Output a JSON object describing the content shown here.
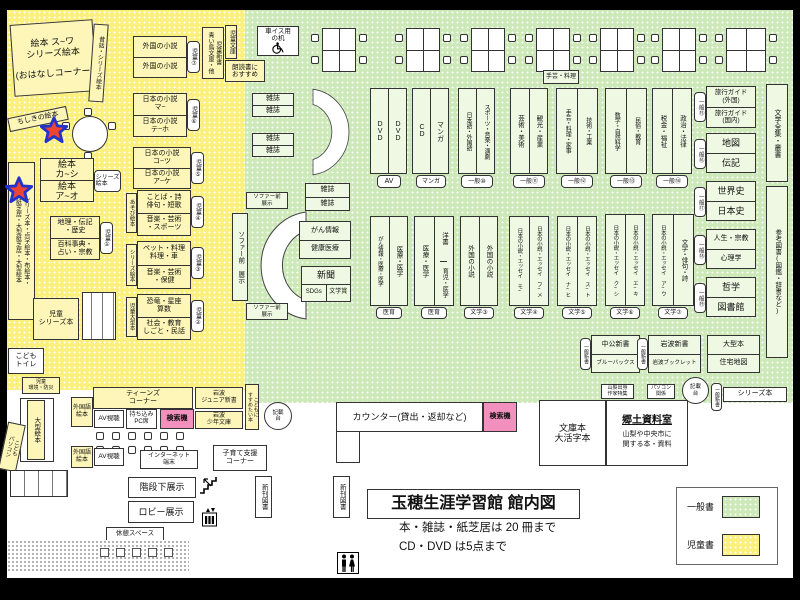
{
  "title": {
    "main": "玉穂生涯学習館 館内図",
    "note1": "本・雑誌・紙芝居は 20 冊まで",
    "note2": "CD・DVD は5点まで"
  },
  "legend": {
    "general": "一般書",
    "children": "児童書"
  },
  "children_zone": {
    "ehon_corner": "絵本 ス~ワ\nシリーズ絵本\n\n(おはなしコーナー)",
    "mukashibanashi": "昔話・シリーズ絵本",
    "chishiki_ehon": "ちしきの絵本",
    "special_ehon": "シリーズ本・点字絵本・布絵本・\n紙芝居・大型紙芝居・大型絵本",
    "ehon_ka_shi": "絵本\nカ~シ",
    "ehon_a_o": "絵本\nア~オ",
    "series_ehon": "シリーズ\n絵本",
    "chiri": "地理・伝記\n・歴史",
    "hyakka": "百科事典・\n占い・宗教",
    "badge_jido1": "児童①",
    "gaikoku_1": "外国の小説",
    "gaikoku_2": "外国の小説",
    "badge_jido7": "児童⑦",
    "nihon_ma": "日本の小説\nマ~",
    "nihon_teho": "日本の小説\nテ~ホ",
    "badge_jido6": "児童⑥",
    "nihon_kotsu": "日本の小説\nコ~ツ",
    "nihon_ake": "日本の小説\nア~ケ",
    "badge_jido5": "児童⑤",
    "kotoba": "ことば・詩\n俳句・短歌",
    "ongaku_sports": "音楽・芸術\n・スポーツ",
    "asobi_ehon": "あそび絵本",
    "badge_jido4": "児童④",
    "pet": "ペット・料理\n料理・車",
    "ongaku_hoken": "音楽・芸術\n・保健",
    "series_ehon_side": "シリーズ絵本",
    "badge_jido3": "児童③",
    "kyoryu": "恐竜・星座\n算数",
    "shakai": "社会・教育\nしごと・民話",
    "jido_ogata": "児童大型本",
    "badge_jido2": "児童②",
    "jido_shinsho": "児童新書\n青い鳥文庫・他",
    "jido_bunko": "児童文庫",
    "rodoku": "朗読書に\nおすすめ",
    "jido_series": "児童\nシリーズ本",
    "kodomo_toilet": "こども\nトイレ",
    "jido_kankyo": "児童\n環境・防災",
    "ogata_ehon": "大型絵本",
    "kodomo_pc": "こども\nパソコン"
  },
  "teens_zone": {
    "teens_corner": "ティーンズ\nコーナー",
    "gaikokugo_ehon1": "外国語\n絵本",
    "gaikokugo_ehon2": "外国語\n絵本",
    "av1": "AV視聴",
    "av2": "AV視聴",
    "pc_seat": "持ち込み\nPC席",
    "search1": "検索機",
    "iwanami_junior": "岩波\nジュニア新書",
    "iwanami_shonen": "岩波\n少年文庫",
    "kodomoni": "こどもに\nすすめたい本",
    "internet": "インターネット\n端末",
    "kosodate": "子育て支援\nコーナー",
    "kaidan": "階段下展示",
    "lobby": "ロビー展示",
    "kyukei": "休憩スペース",
    "shinkan1": "新刊図書",
    "shinkan2": "新刊図書"
  },
  "general_zone": {
    "wheelchair_desk": "車イス用\nの机",
    "zasshi": "雑誌",
    "shugei_ryori": "手芸・料理",
    "sofa_exhibit_h1": "ソファー前\n展示",
    "sofa_exhibit_v": "ソファー前 展示",
    "sofa_exhibit_h2": "ソファー前\n展示",
    "gan_joho": "がん情報",
    "kenko_iryo": "健康医療",
    "shimbun": "新聞",
    "sdgs": "SDGs",
    "bungakusho": "文学賞",
    "shelf_dvd": {
      "c1": "DVD",
      "c2": "DVD",
      "badge": "AV"
    },
    "shelf_cd": {
      "c1": "CD",
      "c2": "マンガ",
      "badge": "マンガ"
    },
    "shelf_lang": {
      "c1": "日本語・外国語",
      "c2": "スポーツ・音楽・演劇",
      "badge": "一般⑩"
    },
    "shelf_art": {
      "c1": "芸術・美術",
      "c2": "観光・産業",
      "badge": "一般⑪"
    },
    "shelf_craft": {
      "c1": "手芸・料理・家事",
      "c2": "技術・工業",
      "badge": "一般⑫"
    },
    "shelf_math": {
      "c1": "数学・自然科学",
      "c2": "民俗・教育",
      "badge": "一般⑬"
    },
    "shelf_tax": {
      "c1": "税金・福祉",
      "c2": "政治・法律",
      "badge": "一般⑭"
    },
    "travel": {
      "r1": "旅行ガイド\n(外国)",
      "r2": "旅行ガイド\n(国内)",
      "badge": "一般⑮"
    },
    "map_box": {
      "r1": "地図",
      "r2": "伝記",
      "badge": "一般⑯"
    },
    "history": {
      "r1": "世界史",
      "r2": "日本史",
      "badge": "一般⑰"
    },
    "life": {
      "r1": "人生・宗教",
      "r2": "心理学",
      "badge": "一般⑱"
    },
    "philosophy": {
      "r1": "哲学",
      "r2": "図書館",
      "badge": "一般⑲"
    },
    "zenshu": "文学全集・叢書",
    "sanko": "参考図書(図鑑・辞書など)",
    "shelf_med1": {
      "c1": "がん情報・医療・医学",
      "c2": "医療・医学",
      "badge": "医育"
    },
    "shelf_med2": {
      "c1": "医療・医学",
      "c2a": "洋書",
      "c2b": "育児・医学",
      "badge": "医育"
    },
    "shelf_foreign": {
      "c1": "外国の小説",
      "c2": "外国の小説",
      "badge": "文学③"
    },
    "shelf_lit4": {
      "c1": "日本の小説・エッセイ モ~",
      "c2": "日本の小説・エッセイ フ~メ",
      "badge": "文学④"
    },
    "shelf_lit5": {
      "c1": "日本の小説・エッセイ ナ~ヒ",
      "c2": "日本の小説・エッセイ ス~ト",
      "badge": "文学⑤"
    },
    "shelf_lit6": {
      "c1": "日本の小説・エッセイ ク~シ",
      "c2": "日本の小説・エッセイ エ~キ",
      "badge": "文学⑥"
    },
    "shelf_lit7": {
      "c1": "日本の小説・エッセイ ア~ウ",
      "c2": "文学・俳句・詩",
      "badge": "文学⑦"
    },
    "chuko": {
      "r1": "中公新書",
      "r2": "ブルーバックス",
      "badge": "一般新書"
    },
    "iwanami": {
      "r1": "岩波新書",
      "r2": "岩波ブックレット",
      "badge": "一般新書"
    },
    "ogata": {
      "r1": "大型本",
      "r2": "住宅地図"
    },
    "yamanashi": "山梨出身\n作家特集",
    "pc_kankei": "パソコン\n関係",
    "kisaidai1": "記載\n台",
    "kisaidai2": "記載\n台",
    "ippan_shinsho": "一般新書",
    "series_bon": "シリーズ本",
    "bunkobon": "文庫本\n大活字本",
    "kyodo": {
      "title": "郷土資料室",
      "desc": "山梨や中央市に\n関する本・資料"
    },
    "counter": "カウンター(貸出・返却など)",
    "search2": "検索機"
  }
}
